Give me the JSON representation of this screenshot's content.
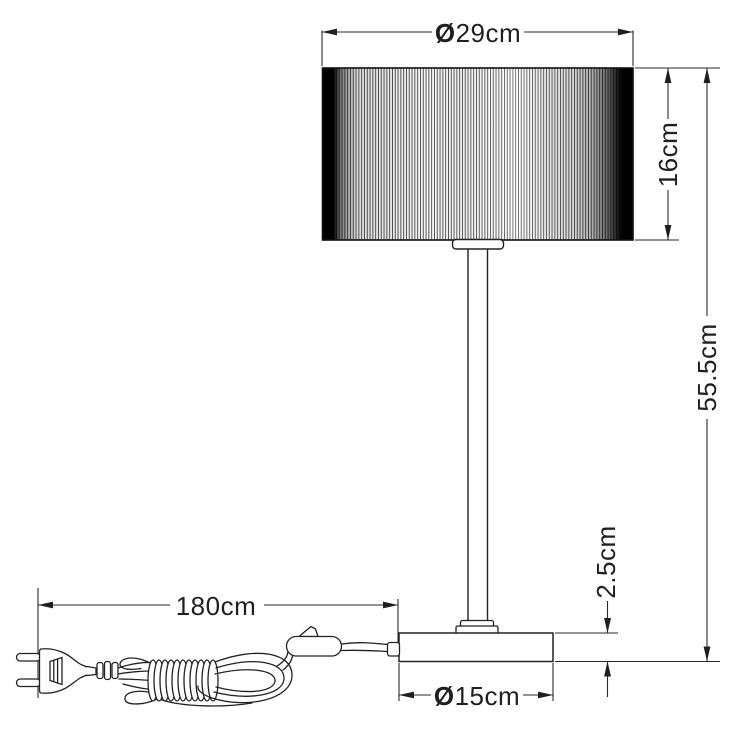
{
  "drawing": {
    "background_color": "#ffffff",
    "line_color": "#222222",
    "text_color": "#1f1f1f",
    "dimensions": {
      "shade_diameter": {
        "symbol": "Ø",
        "value": "29cm"
      },
      "shade_height": "16cm",
      "total_height": "55.5cm",
      "base_height": "2.5cm",
      "base_diameter": {
        "symbol": "Ø",
        "value": "15cm"
      },
      "cord_length": "180cm"
    }
  }
}
